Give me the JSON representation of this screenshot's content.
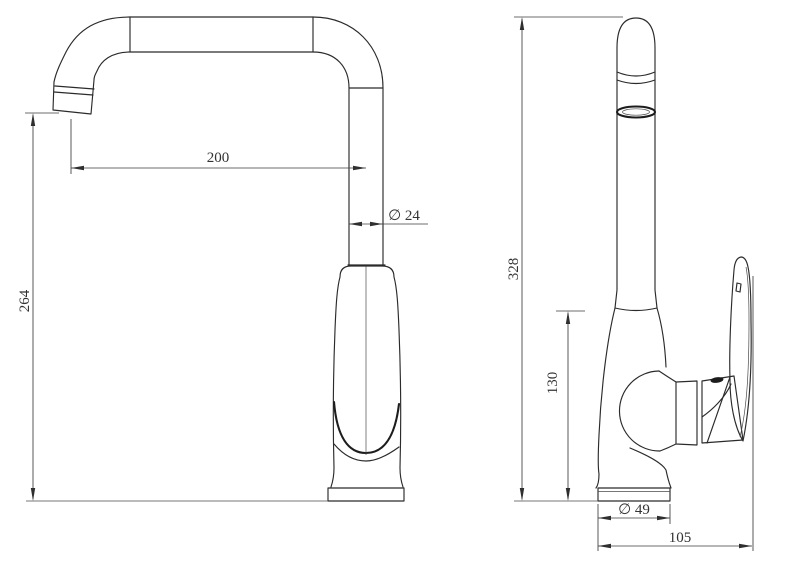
{
  "drawing": {
    "colors": {
      "background": "#ffffff",
      "object_line": "#2b2b2b",
      "dimension_line": "#3d3d3d",
      "text": "#333333"
    },
    "side_view": {
      "dims": {
        "spout_reach": "200",
        "pipe_diameter": "∅ 24",
        "outlet_height": "264"
      }
    },
    "front_view": {
      "dims": {
        "total_height": "328",
        "body_height": "130",
        "base_diameter": "∅ 49",
        "overall_depth": "105"
      }
    }
  }
}
